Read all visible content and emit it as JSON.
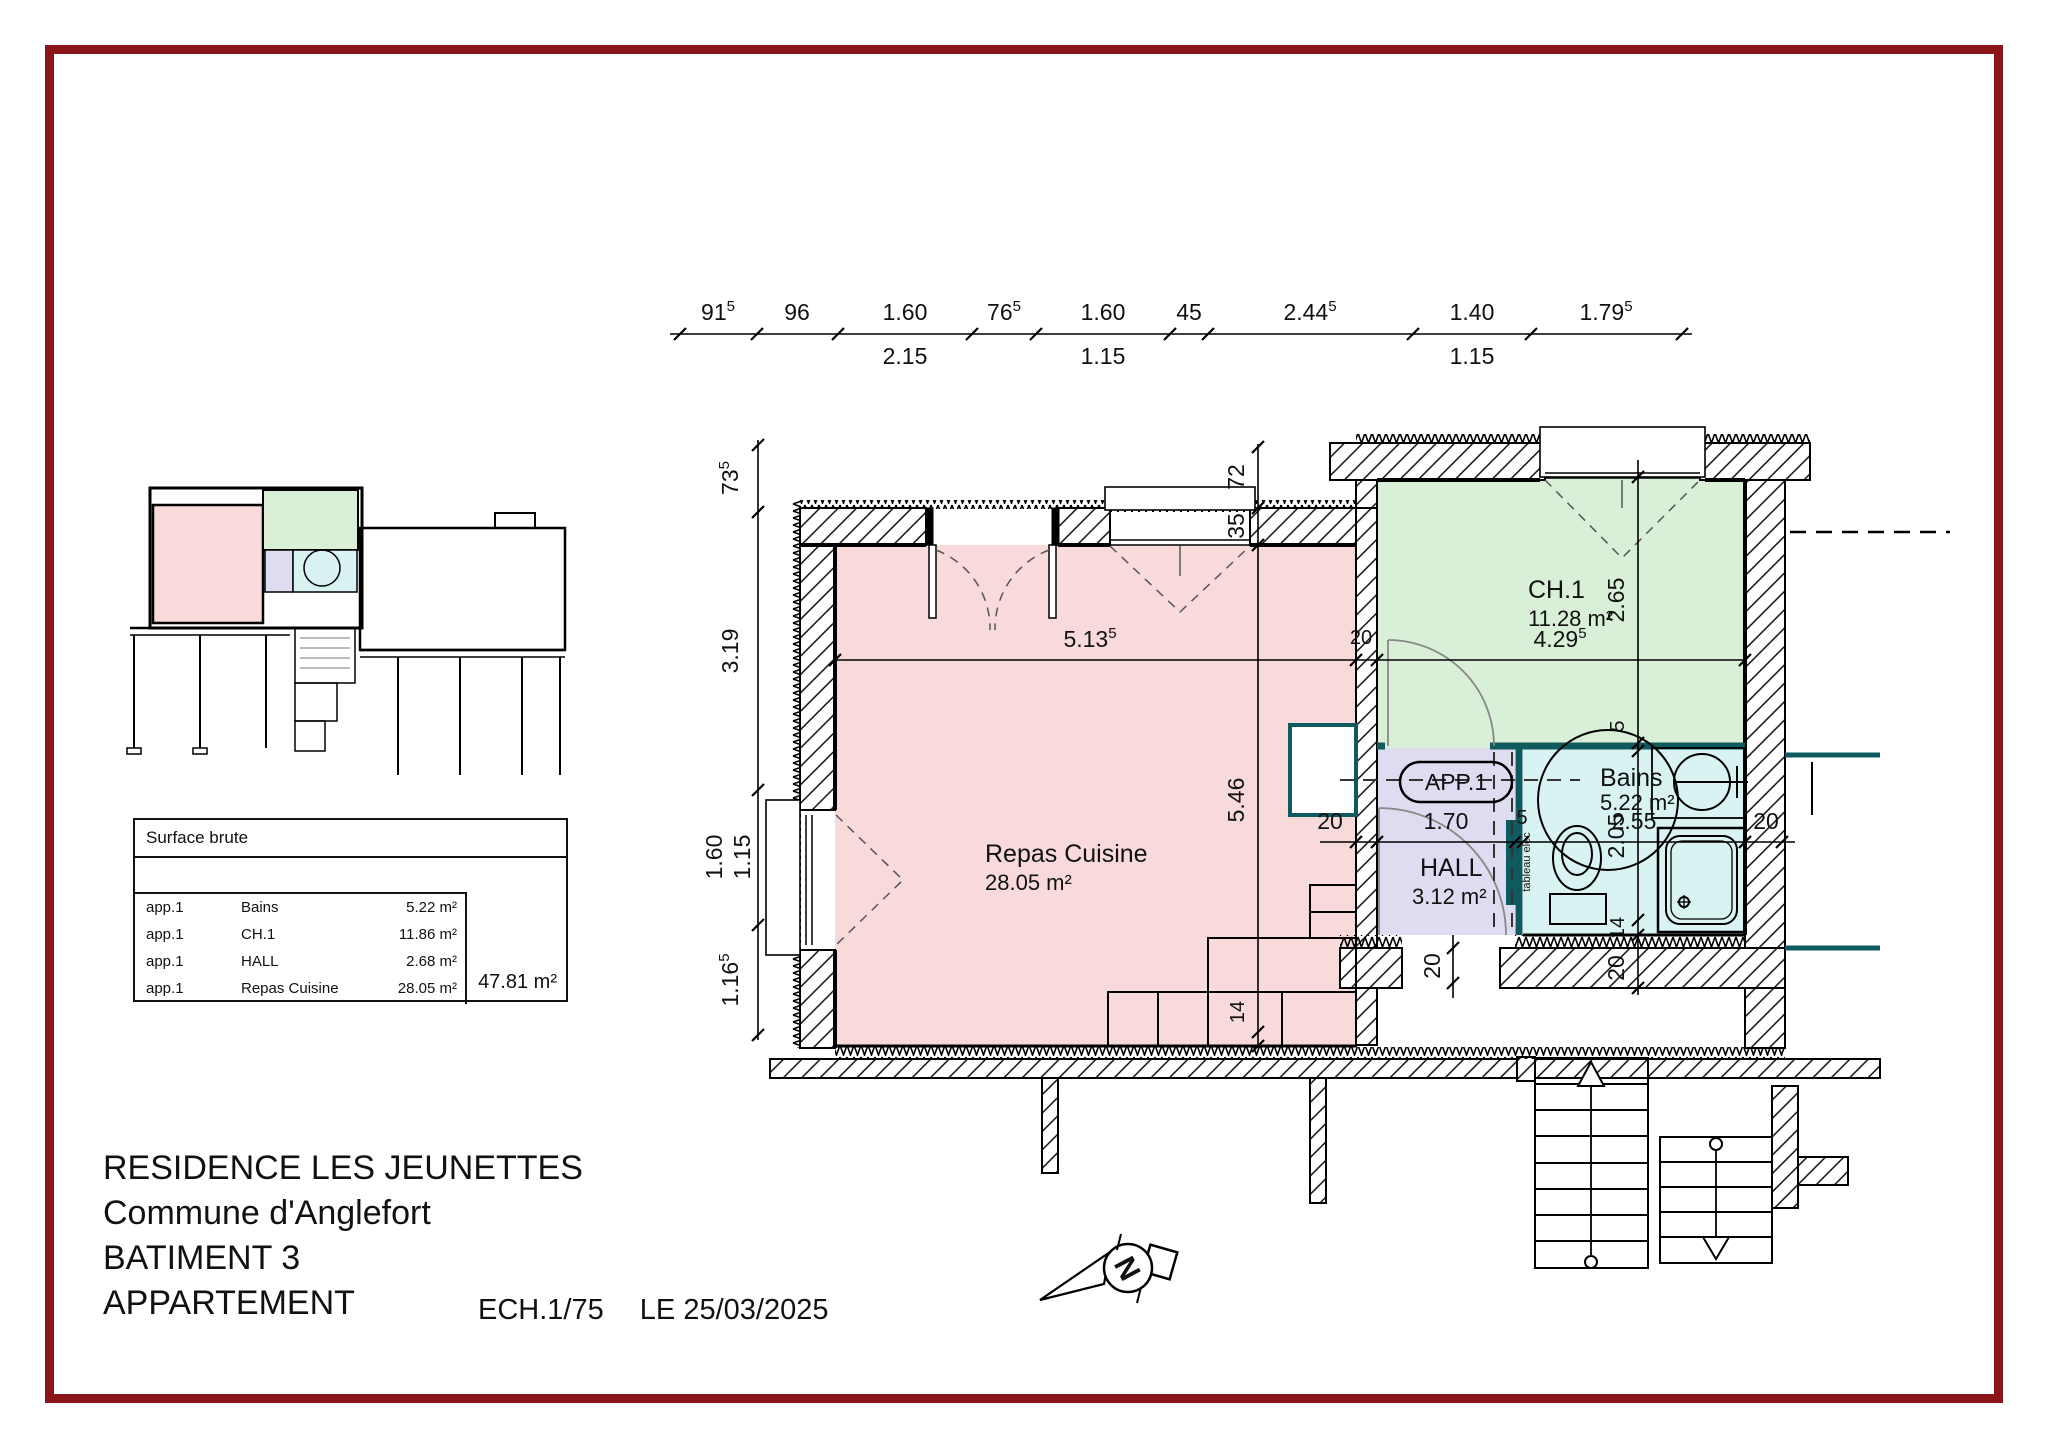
{
  "title_block": {
    "line1": "RESIDENCE LES JEUNETTES",
    "line2": "Commune d'Anglefort",
    "line3": "BATIMENT 3",
    "line4": "APPARTEMENT",
    "scale": "ECH.1/75",
    "date": "LE 25/03/2025"
  },
  "surface_table": {
    "title": "Surface brute",
    "rows": [
      {
        "apt": "app.1",
        "room": "Bains",
        "area": "5.22 m²"
      },
      {
        "apt": "app.1",
        "room": "CH.1",
        "area": "11.86 m²"
      },
      {
        "apt": "app.1",
        "room": "HALL",
        "area": "2.68 m²"
      },
      {
        "apt": "app.1",
        "room": "Repas Cuisine",
        "area": "28.05 m²"
      }
    ],
    "total": "47.81 m²"
  },
  "rooms": {
    "repas": {
      "name": "Repas Cuisine",
      "area": "28.05 m²"
    },
    "ch1": {
      "name": "CH.1",
      "area": "11.28 m²"
    },
    "bains": {
      "name": "Bains",
      "area": "5.22 m²"
    },
    "hall": {
      "name": "HALL",
      "area": "3.12 m²"
    }
  },
  "labels": {
    "apartment": "APP.1",
    "tableau_elec": "tableau elec",
    "north": "N"
  },
  "dims": {
    "top_row": [
      {
        "v": "91",
        "s": "5"
      },
      {
        "v": "96",
        "s": ""
      },
      {
        "v": "1.60",
        "s": ""
      },
      {
        "v": "76",
        "s": "5"
      },
      {
        "v": "1.60",
        "s": ""
      },
      {
        "v": "45",
        "s": ""
      },
      {
        "v": "2.44",
        "s": "5"
      },
      {
        "v": "1.40",
        "s": ""
      },
      {
        "v": "1.79",
        "s": "5"
      }
    ],
    "top_sub": [
      "2.15",
      "1.15",
      "1.15"
    ],
    "left": [
      {
        "v": "73",
        "s": "5"
      },
      {
        "v": "3.19",
        "s": ""
      },
      {
        "v": "1.60",
        "s": ""
      },
      {
        "v": "1.15",
        "s": ""
      },
      {
        "v": "1.16",
        "s": "5"
      }
    ],
    "plan": {
      "w_repas": {
        "v": "5.13",
        "s": "5"
      },
      "wall20": "20",
      "w_ch1": {
        "v": "4.29",
        "s": "5"
      },
      "h_repas": "5.46",
      "win72": "72",
      "win35": "35",
      "h_ch1": "2.65",
      "p5": "5",
      "h_bains": "2.05",
      "w14a": "14",
      "b20": "20",
      "hall_wall20": "20",
      "w_hall": "1.70",
      "part5": "5",
      "w_bains": "2.55",
      "right20": "20",
      "entry20": "20",
      "counter14": "14"
    }
  },
  "colors": {
    "repas": "#f9dada",
    "ch1": "#d9efd7",
    "bains": "#d8f3f2",
    "hall": "#dddcf1",
    "partition": "#0e5a5e",
    "frame": "#8a1518"
  }
}
